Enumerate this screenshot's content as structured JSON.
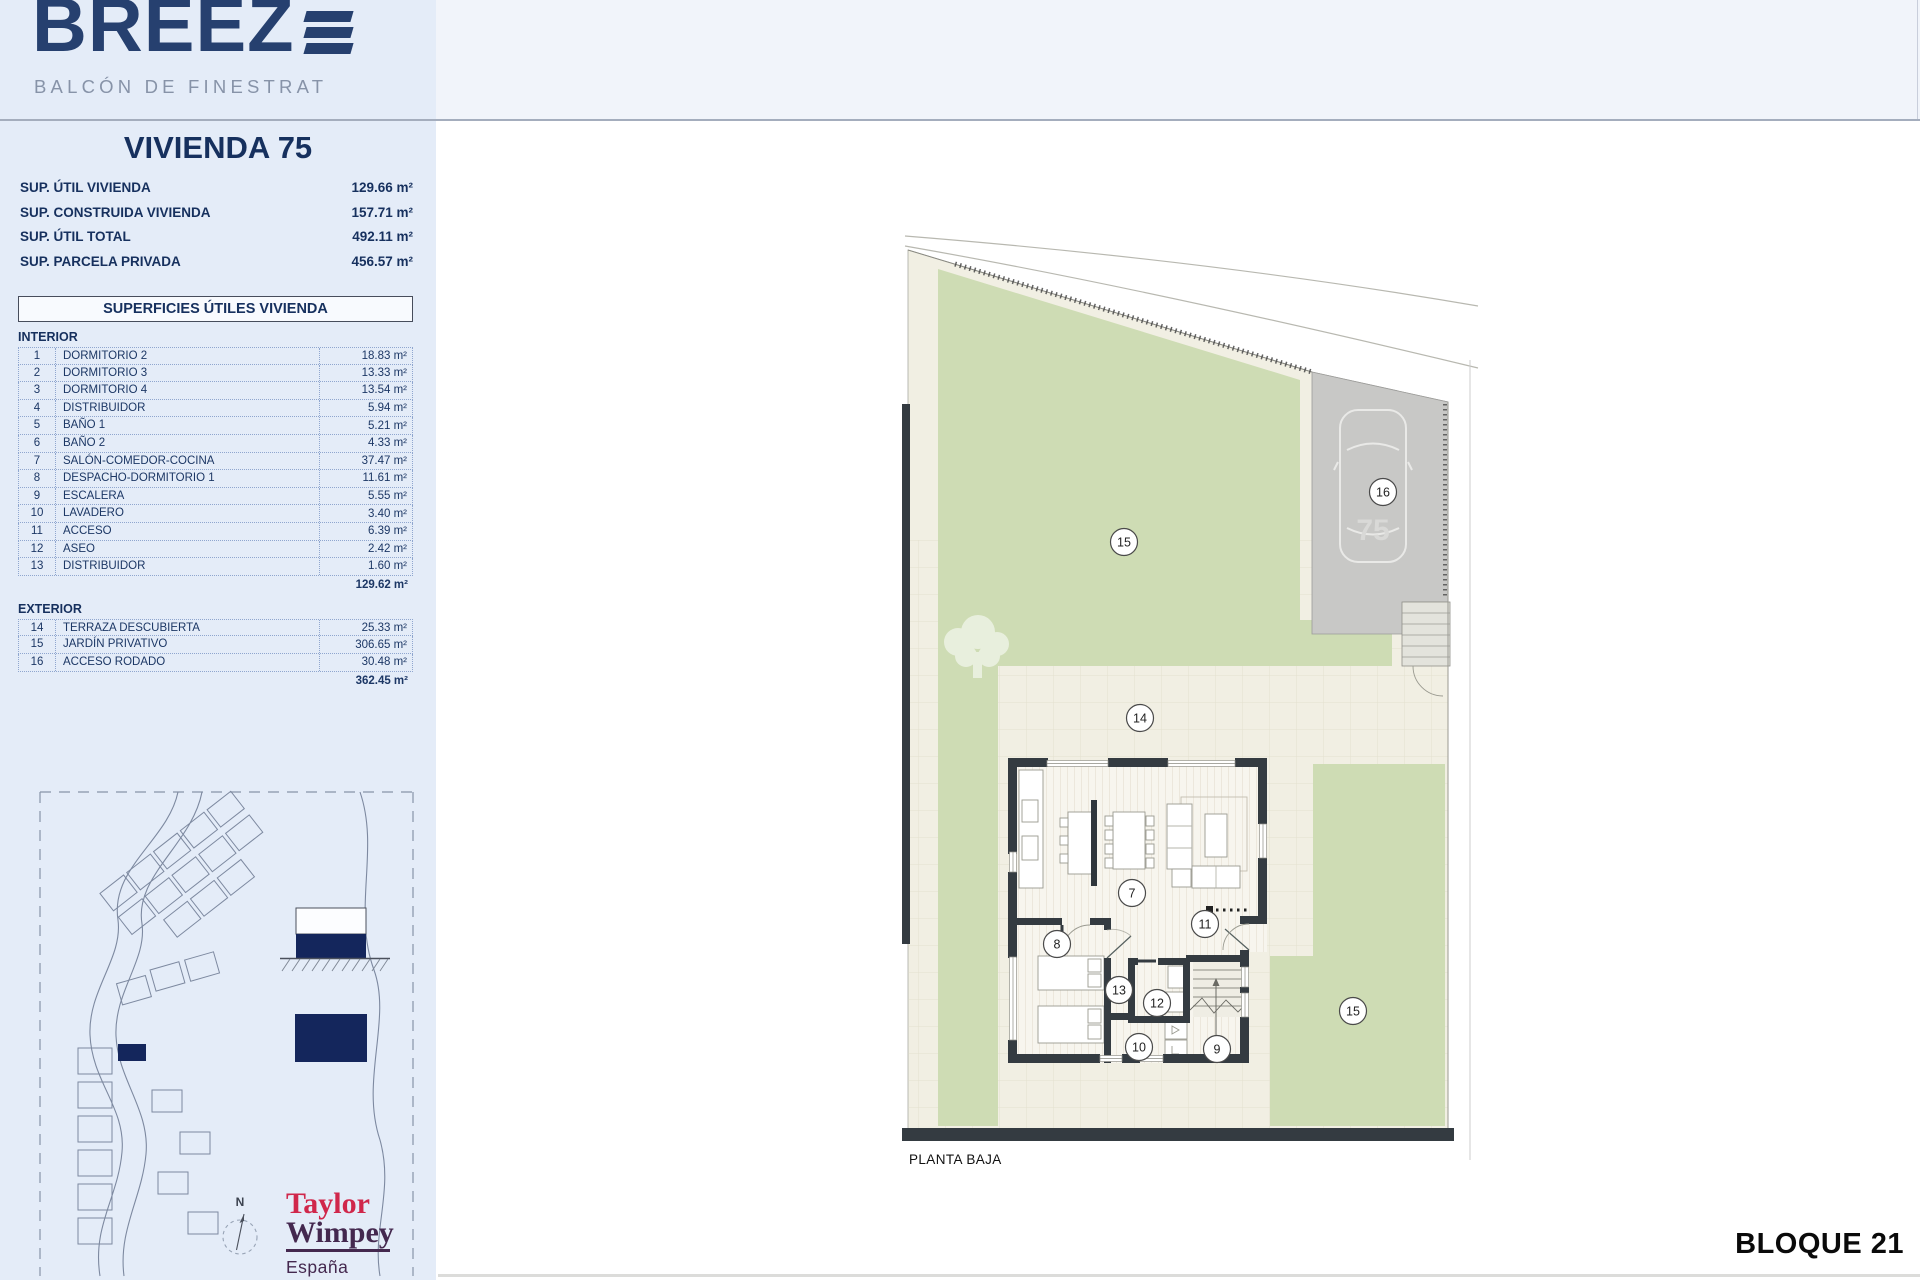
{
  "sidebar": {
    "logo_text": "BREEZ",
    "logo_subtitle": "BALCÓN DE FINESTRAT",
    "title": "VIVIENDA 75",
    "summary": [
      {
        "label": "SUP. ÚTIL VIVIENDA",
        "value": "129.66 m²"
      },
      {
        "label": "SUP. CONSTRUIDA VIVIENDA",
        "value": "157.71 m²"
      },
      {
        "label": "SUP. ÚTIL TOTAL",
        "value": "492.11 m²"
      },
      {
        "label": "SUP. PARCELA PRIVADA",
        "value": "456.57 m²"
      }
    ],
    "table": {
      "header": "SUPERFICIES ÚTILES VIVIENDA",
      "interior_label": "INTERIOR",
      "interior_rows": [
        {
          "num": "1",
          "name": "DORMITORIO 2",
          "value": "18.83 m²"
        },
        {
          "num": "2",
          "name": "DORMITORIO 3",
          "value": "13.33 m²"
        },
        {
          "num": "3",
          "name": "DORMITORIO 4",
          "value": "13.54 m²"
        },
        {
          "num": "4",
          "name": "DISTRIBUIDOR",
          "value": "5.94 m²"
        },
        {
          "num": "5",
          "name": "BAÑO 1",
          "value": "5.21 m²"
        },
        {
          "num": "6",
          "name": "BAÑO 2",
          "value": "4.33 m²"
        },
        {
          "num": "7",
          "name": "SALÓN-COMEDOR-COCINA",
          "value": "37.47 m²"
        },
        {
          "num": "8",
          "name": "DESPACHO-DORMITORIO 1",
          "value": "11.61 m²"
        },
        {
          "num": "9",
          "name": "ESCALERA",
          "value": "5.55 m²"
        },
        {
          "num": "10",
          "name": "LAVADERO",
          "value": "3.40 m²"
        },
        {
          "num": "11",
          "name": "ACCESO",
          "value": "6.39 m²"
        },
        {
          "num": "12",
          "name": "ASEO",
          "value": "2.42 m²"
        },
        {
          "num": "13",
          "name": "DISTRIBUIDOR",
          "value": "1.60 m²"
        }
      ],
      "interior_total": "129.62 m²",
      "exterior_label": "EXTERIOR",
      "exterior_rows": [
        {
          "num": "14",
          "name": "TERRAZA DESCUBIERTA",
          "value": "25.33 m²"
        },
        {
          "num": "15",
          "name": "JARDÍN PRIVATIVO",
          "value": "306.65 m²"
        },
        {
          "num": "16",
          "name": "ACCESO RODADO",
          "value": "30.48 m²"
        }
      ],
      "exterior_total": "362.45 m²"
    },
    "compass_label": "N",
    "developer": {
      "name_top": "Taylor",
      "name_bottom": "Wimpey",
      "region": "España"
    }
  },
  "plan": {
    "floor_label": "PLANTA BAJA",
    "block_label": "BLOQUE 21",
    "unit_number": "75",
    "markers": [
      {
        "label": "15"
      },
      {
        "label": "16"
      },
      {
        "label": "14"
      },
      {
        "label": "7"
      },
      {
        "label": "8"
      },
      {
        "label": "11"
      },
      {
        "label": "13"
      },
      {
        "label": "12"
      },
      {
        "label": "10"
      },
      {
        "label": "9"
      },
      {
        "label": "15"
      }
    ]
  },
  "colors": {
    "brand_navy": "#26406f",
    "text_navy": "#16305e",
    "garden_green": "#cedcb4",
    "driveway_gray": "#c8c8c6",
    "wall_dark": "#343b41",
    "terrace_cream": "#f1efe3",
    "highlight_navy": "#14265c",
    "tw_red": "#d0274b",
    "tw_purple": "#44284f"
  }
}
